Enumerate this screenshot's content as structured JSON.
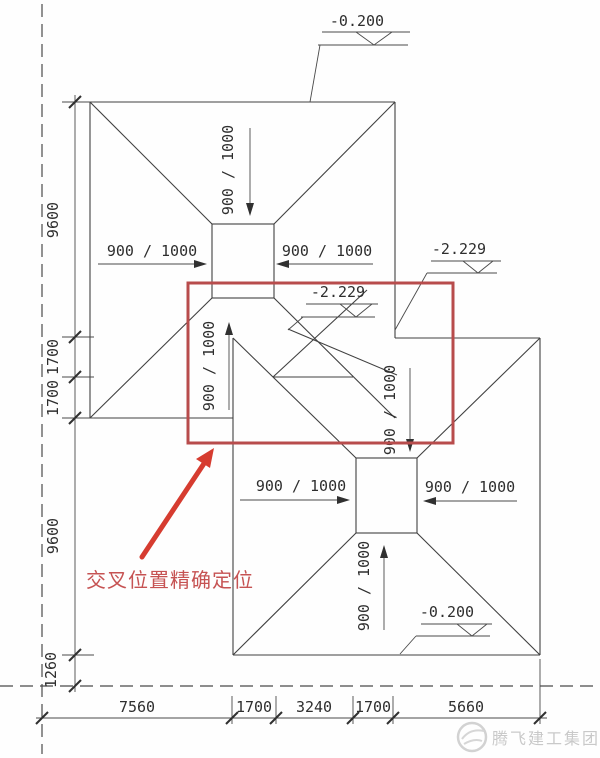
{
  "drawing": {
    "title_hint": "foundation pit excavation intersection plan",
    "elevations": {
      "ground_top": "-0.200",
      "pit_inner": "-2.229",
      "pit_outer": "-2.229",
      "ground_bottom": "-0.200"
    },
    "slope_label": "900 / 1000",
    "dimensions": {
      "left": [
        "9600",
        "1700",
        "1700",
        "9600",
        "1260"
      ],
      "bottom": [
        "7560",
        "1700",
        "3240",
        "1700",
        "5660"
      ]
    },
    "callout": {
      "text": "交叉位置精确定位",
      "color": "#c65353",
      "arrow_color": "#d63c30"
    },
    "highlight_color": "#b84c4c",
    "line_color": "#404040",
    "watermark": {
      "text": "腾飞建工集团",
      "color": "#c9c9c9"
    }
  }
}
